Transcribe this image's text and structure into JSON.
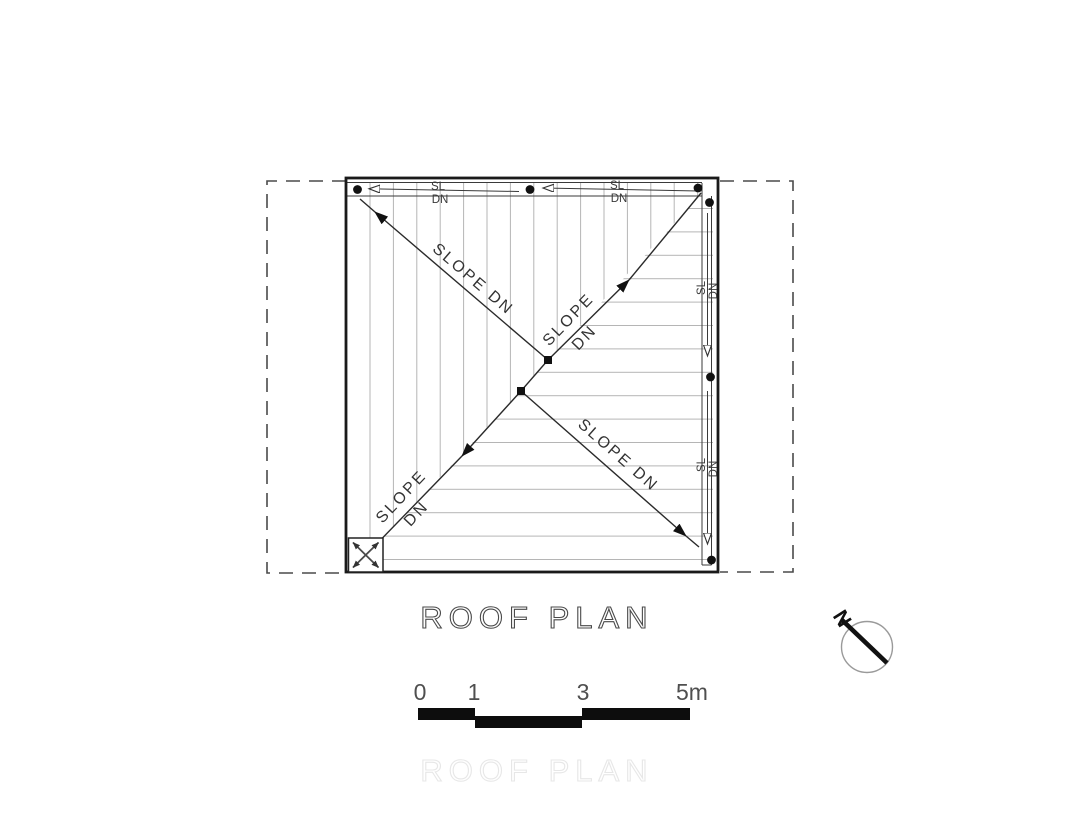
{
  "drawing": {
    "title": "ROOF PLAN",
    "watermark": "ROOF PLAN",
    "north_label": "N",
    "scale_ticks": [
      "0",
      "1",
      "3",
      "5m"
    ],
    "gutter_labels": {
      "sl": "SL",
      "dn": "DN"
    },
    "slope_labels": {
      "full": "SLOPE DN",
      "word_slope": "SLOPE",
      "word_dn": "DN"
    },
    "colors": {
      "outline": "#1a1a1a",
      "thin_line": "#3a3a3a",
      "hatch": "#b5b5b5",
      "dashed_boundary": "#4a4a4a",
      "scale_bar": "#0d0d0d",
      "title_outline": "#4a4a4a",
      "watermark_outline": "#e7e7e7"
    }
  }
}
